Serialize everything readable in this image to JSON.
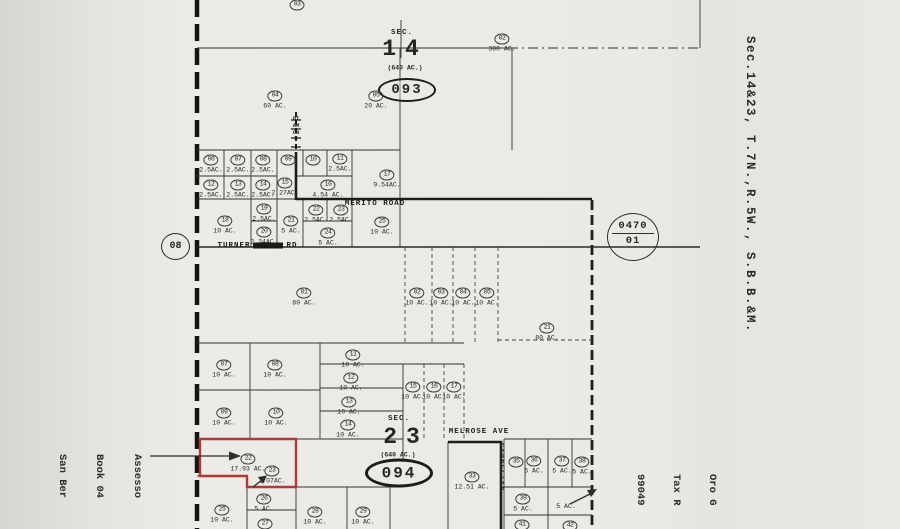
{
  "map": {
    "highlight_color": "#b23b31",
    "sheet": {
      "adjacent_left": "08",
      "ref_top": "0470",
      "ref_bottom": "01"
    },
    "margins": {
      "right": "Sec.14&23, T.7N.,R.5W., S.B.B.&M.",
      "bottom_left": [
        "Assesso",
        "Book 04",
        "San Ber"
      ],
      "bottom_right": [
        "Oro G",
        "Tax R",
        "99049"
      ]
    },
    "sec14": {
      "sec": "SEC.",
      "num": "14",
      "acre": "(640 AC.)",
      "oval": "093",
      "roads": {
        "diamond": "DIAMOND",
        "merito": "MERITO ROAD",
        "turner1": "TURNER",
        "turner2": "RD"
      },
      "north": [
        {
          "num": "03",
          "ac": ""
        },
        {
          "num": "02",
          "ac": "300 AC."
        }
      ],
      "parcels": [
        {
          "num": "04",
          "ac": "60 AC."
        },
        {
          "num": "05",
          "ac": "20 AC."
        },
        {
          "num": "06",
          "ac": "2.5AC."
        },
        {
          "num": "07",
          "ac": "2.5AC."
        },
        {
          "num": "08",
          "ac": "2.5AC."
        },
        {
          "num": "09",
          "ac": ""
        },
        {
          "num": "10",
          "ac": ""
        },
        {
          "num": "11",
          "ac": "2.5AC."
        },
        {
          "num": "12",
          "ac": "2.5AC."
        },
        {
          "num": "13",
          "ac": "2.5AC."
        },
        {
          "num": "14",
          "ac": "2.5AC."
        },
        {
          "num": "15",
          "ac": "2.27AC."
        },
        {
          "num": "16",
          "ac": "4.54 AC."
        },
        {
          "num": "17",
          "ac": "9.54AC."
        },
        {
          "num": "18",
          "ac": "10 AC."
        },
        {
          "num": "19",
          "ac": "2.5AC."
        },
        {
          "num": "20",
          "ac": "2.34AC."
        },
        {
          "num": "21",
          "ac": "5 AC."
        },
        {
          "num": "22",
          "ac": "2.5AC."
        },
        {
          "num": "23",
          "ac": "2.5AC."
        },
        {
          "num": "24",
          "ac": "5 AC."
        },
        {
          "num": "25",
          "ac": "10 AC."
        }
      ]
    },
    "sec23": {
      "sec": "SEC.",
      "num": "23",
      "acre": "(640 AC.)",
      "oval": "094",
      "roads": {
        "melrose": "MELROSE AVE",
        "carnelian": "CARNELIAN"
      },
      "parcels": [
        {
          "num": "01",
          "ac": "80 AC."
        },
        {
          "num": "02",
          "ac": "10 AC."
        },
        {
          "num": "03",
          "ac": "10 AC."
        },
        {
          "num": "04",
          "ac": "10 AC."
        },
        {
          "num": "05",
          "ac": "10 AC."
        },
        {
          "num": "21",
          "ac": "80 AC."
        },
        {
          "num": "07",
          "ac": "10 AC."
        },
        {
          "num": "08",
          "ac": "10 AC."
        },
        {
          "num": "09",
          "ac": "10 AC."
        },
        {
          "num": "10",
          "ac": "10 AC."
        },
        {
          "num": "11",
          "ac": "10 AC."
        },
        {
          "num": "12",
          "ac": "10 AC."
        },
        {
          "num": "13",
          "ac": "10 AC."
        },
        {
          "num": "14",
          "ac": "10 AC."
        },
        {
          "num": "15",
          "ac": "10 AC."
        },
        {
          "num": "16",
          "ac": "10 AC."
        },
        {
          "num": "17",
          "ac": "10 AC."
        },
        {
          "num": "22",
          "ac": "17.93 AC."
        },
        {
          "num": "23",
          "ac": "2.07AC."
        },
        {
          "num": "25",
          "ac": "10 AC."
        },
        {
          "num": "26",
          "ac": "5 AC."
        },
        {
          "num": "27",
          "ac": ""
        },
        {
          "num": "28",
          "ac": "10 AC."
        },
        {
          "num": "29",
          "ac": "10 AC."
        },
        {
          "num": "33",
          "ac": "12.51 AC."
        },
        {
          "num": "35",
          "ac": ""
        },
        {
          "num": "36",
          "ac": "5 AC."
        },
        {
          "num": "37",
          "ac": "5 AC."
        },
        {
          "num": "38",
          "ac": "5 AC."
        },
        {
          "num": "39",
          "ac": "5 AC."
        },
        {
          "num": "",
          "ac": "5 AC."
        },
        {
          "num": "41",
          "ac": ""
        },
        {
          "num": "42",
          "ac": ""
        }
      ]
    }
  }
}
